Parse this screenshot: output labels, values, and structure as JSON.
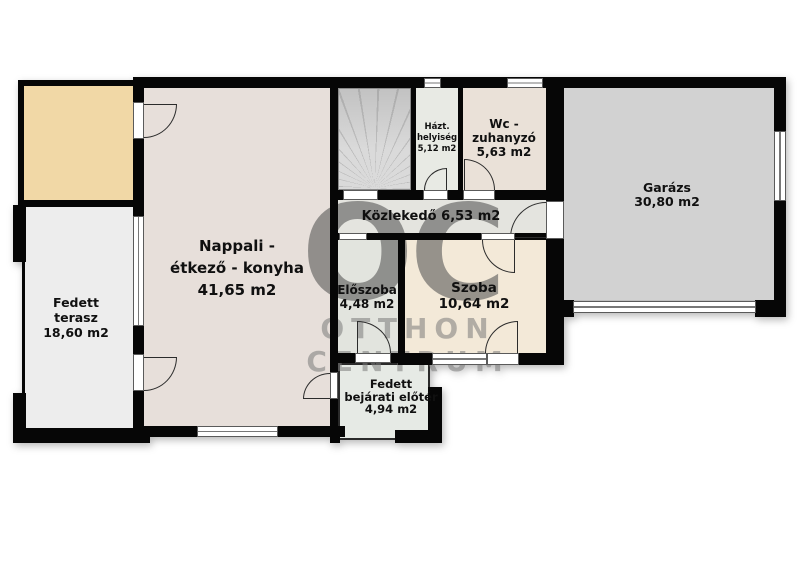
{
  "watermark": {
    "logo": "OC",
    "line1": "OTTHON",
    "line2": "CENTRUM"
  },
  "palette": {
    "wall": "#060606",
    "nappali": "#e7dfda",
    "tan_room": "#f1d8a6",
    "terrace": "#ededed",
    "stairs": "#d7d7d7",
    "hazt": "#e8eae4",
    "wc": "#eae1d8",
    "kozlekedo": "#e4e4df",
    "eloszoba": "#e2e4de",
    "szoba": "#f3e9d8",
    "porch": "#e6eae5",
    "garage": "#d2d2d2"
  },
  "rooms": {
    "nappali": {
      "name": "Nappali -\nétkező - konyha",
      "area": "41,65 m2"
    },
    "terasz": {
      "name": "Fedett\nterasz",
      "area": "18,60 m2"
    },
    "hazt": {
      "name": "Házt.\nhelyiség",
      "area": "5,12 m2"
    },
    "wc": {
      "name": "Wc -\nzuhanyzó",
      "area": "5,63 m2"
    },
    "garazs": {
      "name": "Garázs",
      "area": "30,80 m2"
    },
    "kozlekedo": {
      "name": "Közlekedő",
      "area": "6,53 m2"
    },
    "eloszoba": {
      "name": "Előszoba",
      "area": "4,48 m2"
    },
    "szoba": {
      "name": "Szoba",
      "area": "10,64 m2"
    },
    "bejarati": {
      "name": "Fedett\nbejárati előtér",
      "area": "4,94 m2"
    }
  }
}
